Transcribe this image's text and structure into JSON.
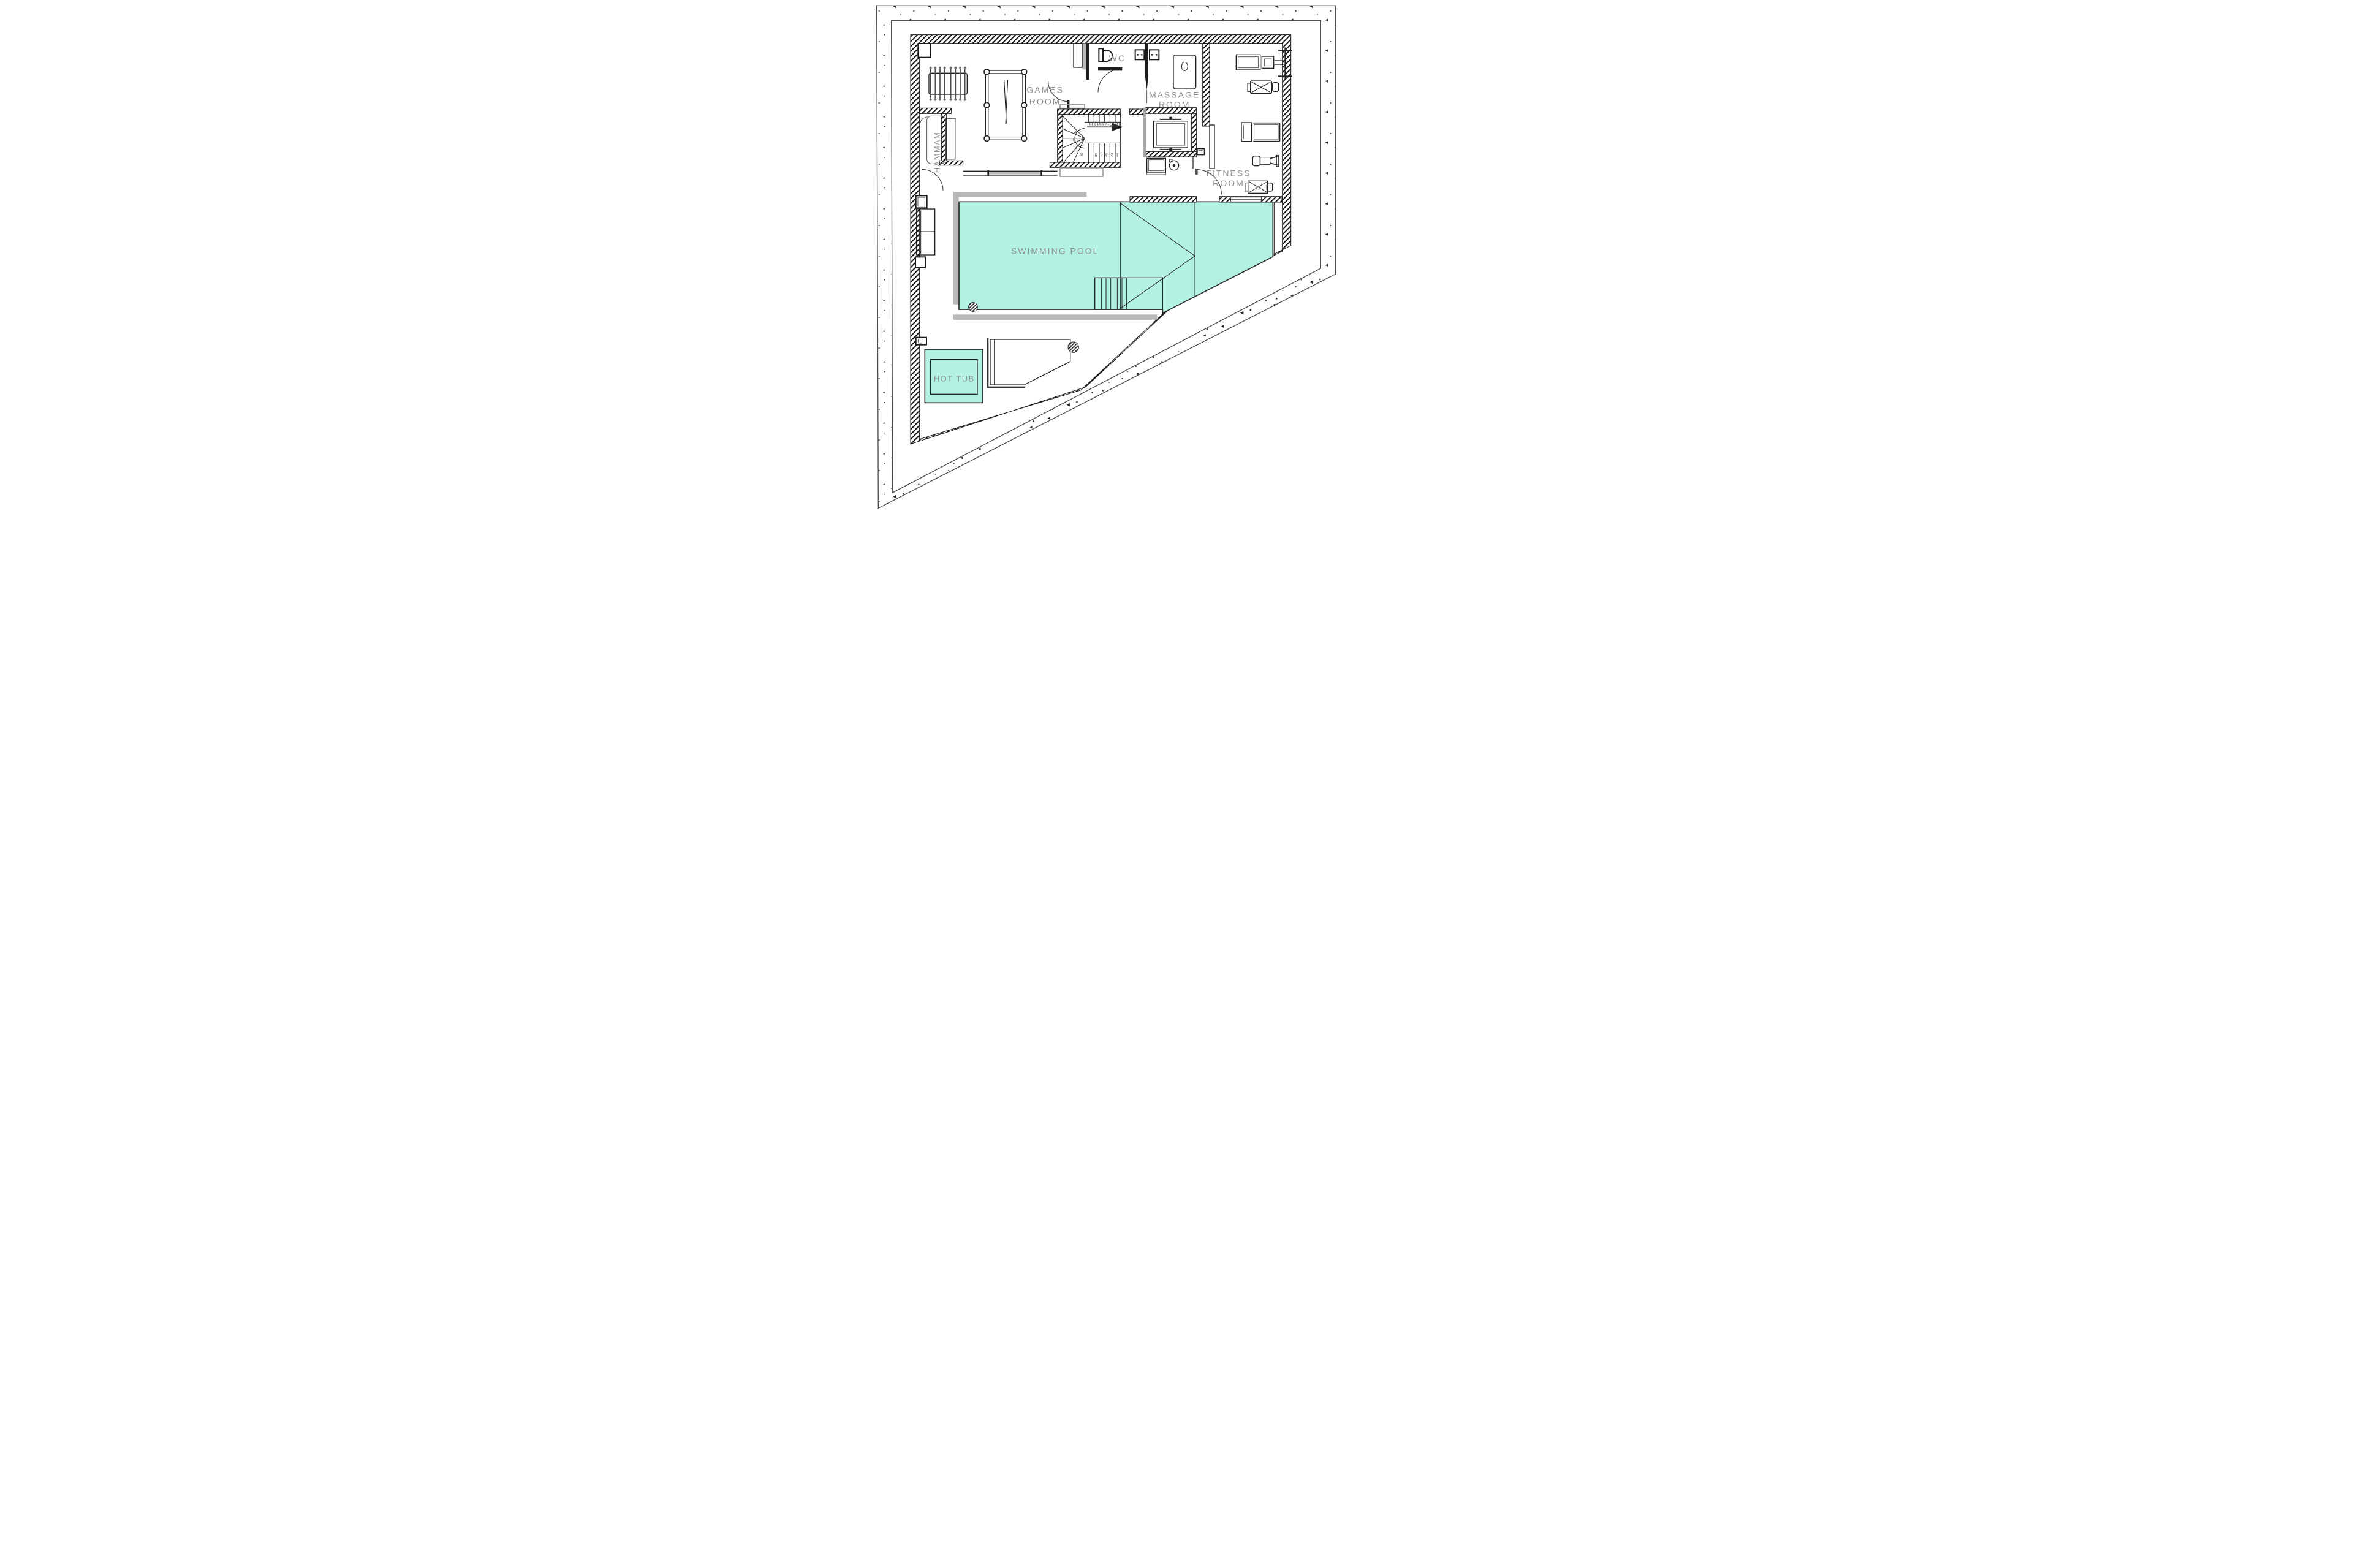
{
  "plan": {
    "type": "architectural-floor-plan",
    "labels": {
      "games1": "GAMES",
      "games2": "ROOM",
      "wc": "WC",
      "massage1": "MASSAGE",
      "massage2": "ROOM",
      "fitness1": "FITNESS",
      "fitness2": "ROOM",
      "hammam": "HAMMAM",
      "pool": "SWIMMING POOL",
      "hottub": "HOT TUB"
    },
    "stairs": {
      "numbers": [
        "1",
        "2",
        "3",
        "4",
        "5",
        "6",
        "7",
        "8",
        "9",
        "10",
        "11",
        "12",
        "13",
        "14",
        "15",
        "16"
      ],
      "direction_icon": "arrow-right"
    },
    "colors": {
      "water": "#b3f2e2",
      "label_text": "#8f8f8f",
      "wall_hatch": "#1a1a1a",
      "deck": "#b8b8b8"
    }
  }
}
